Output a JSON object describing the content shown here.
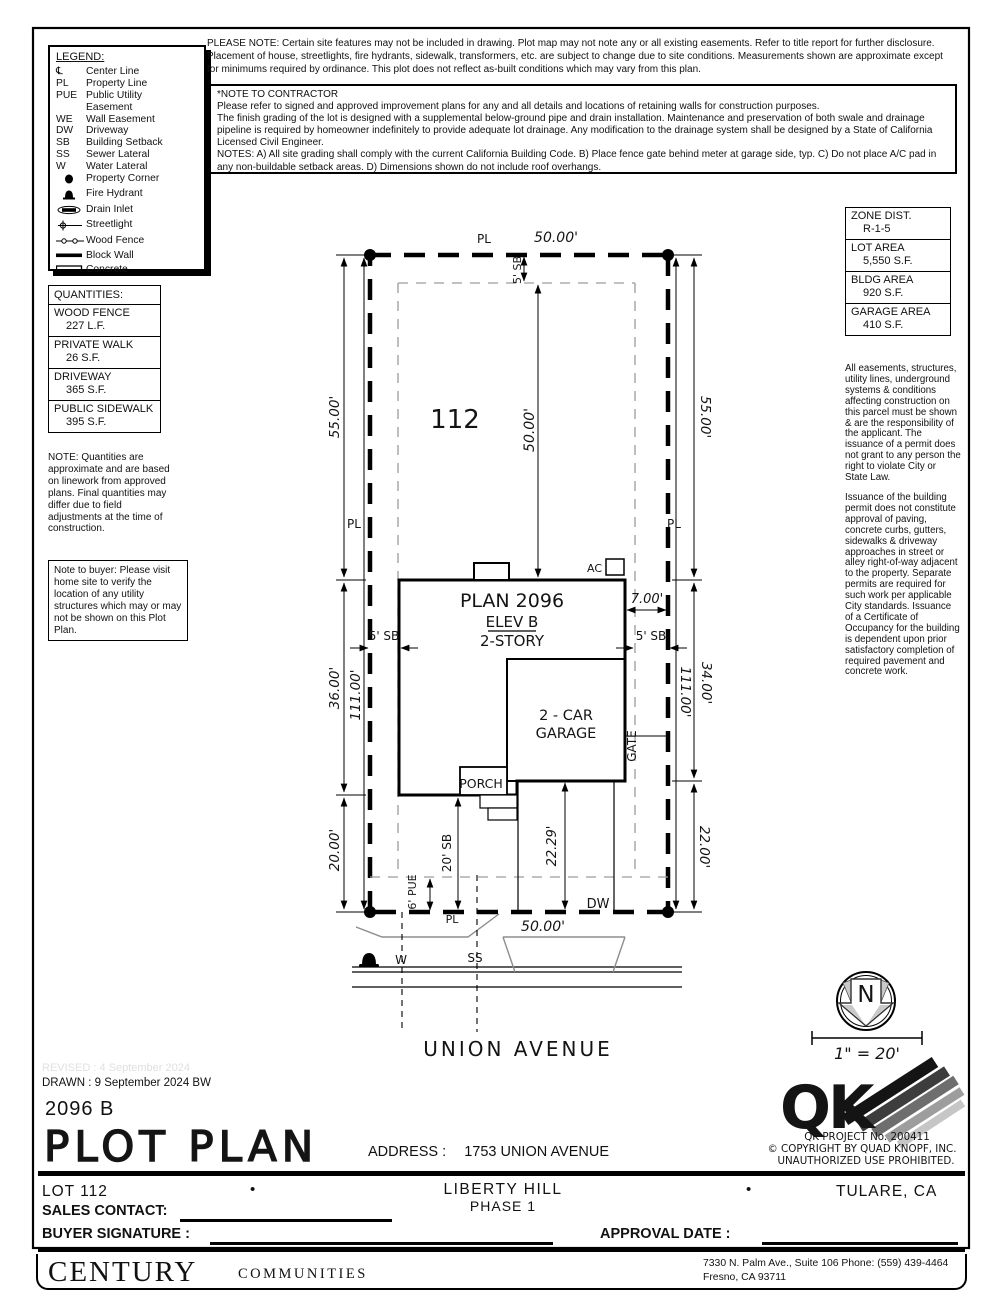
{
  "header": {
    "please_note": "PLEASE NOTE:  Certain site features may not be included in drawing.  Plot map may not note any or all existing easements. Refer to title report for further disclosure.  Placement of house, streetlights, fire hydrants, sidewalk, transformers, etc. are subject to change due to site conditions.  Measurements shown are approximate except for minimums required by ordinance.  This plot does not reflect as-built conditions which may vary from this plan.",
    "contractor_title": "*NOTE TO CONTRACTOR",
    "contractor_p1": "Please refer to signed and approved improvement plans for any and all details and locations of retaining walls for construction purposes.",
    "contractor_p2": "The finish grading of the lot is designed with a supplemental below-ground pipe and drain installation.  Maintenance and preservation of both swale and drainage pipeline is required by homeowner indefinitely to provide adequate lot drainage.  Any modification to the drainage system shall be designed by a State of California Licensed Civil Engineer.",
    "contractor_p3": "NOTES:  A) All site grading shall comply with the current California Building Code.  B) Place fence gate behind meter at garage side, typ.  C) Do not place A/C pad in any non-buildable setback areas.  D) Dimensions shown do not include roof overhangs."
  },
  "legend": {
    "title": "LEGEND:",
    "items": [
      {
        "sym": "℄",
        "label": "Center Line"
      },
      {
        "sym": "PL",
        "label": "Property Line"
      },
      {
        "sym": "PUE",
        "label": "Public Utility Easement"
      },
      {
        "sym": "WE",
        "label": "Wall Easement"
      },
      {
        "sym": "DW",
        "label": "Driveway"
      },
      {
        "sym": "SB",
        "label": "Building Setback"
      },
      {
        "sym": "SS",
        "label": "Sewer Lateral"
      },
      {
        "sym": "W",
        "label": "Water Lateral"
      },
      {
        "sym": "",
        "label": "Property Corner"
      },
      {
        "sym": "",
        "label": "Fire Hydrant"
      },
      {
        "sym": "",
        "label": "Drain Inlet"
      },
      {
        "sym": "",
        "label": "Streetlight"
      },
      {
        "sym": "",
        "label": "Wood Fence"
      },
      {
        "sym": "",
        "label": "Block Wall"
      },
      {
        "sym": "",
        "label": "Concrete"
      }
    ]
  },
  "zone_table": {
    "rows": [
      {
        "label": "ZONE DIST.",
        "value": "R-1-5"
      },
      {
        "label": "LOT AREA",
        "value": "5,550 S.F."
      },
      {
        "label": "BLDG AREA",
        "value": "920 S.F."
      },
      {
        "label": "GARAGE AREA",
        "value": "410 S.F."
      }
    ]
  },
  "quantities": {
    "title": "QUANTITIES:",
    "rows": [
      {
        "label": "WOOD FENCE",
        "value": "227 L.F."
      },
      {
        "label": "PRIVATE WALK",
        "value": "26 S.F."
      },
      {
        "label": "DRIVEWAY",
        "value": "365 S.F."
      },
      {
        "label": "PUBLIC SIDEWALK",
        "value": "395 S.F."
      }
    ],
    "note": "NOTE: Quantities are approximate and are based on linework from approved plans.  Final quantities may differ due to field adjustments at the time of construction."
  },
  "buyer_note": "Note to buyer: Please visit home site to verify the location of any utility structures which may or may not be shown on this Plot Plan.",
  "side_notes": {
    "p1": "All easements, structures, utility lines, underground systems & conditions affecting construction on this parcel must be shown & are the responsibility of the applicant. The issuance of a permit does not grant to any person the right to violate City or State Law.",
    "p2": "Issuance of the building permit does not constitute approval of paving, concrete curbs, gutters, sidewalks & driveway approaches in street or alley right-of-way adjacent to the property. Separate permits are required for such work per applicable City standards. Issuance of a Certificate of Occupancy for the building is dependent upon prior satisfactory completion of required pavement and concrete work."
  },
  "plot": {
    "lot_number": "112",
    "pl_label": "PL",
    "dims": {
      "top_width": "50.00'",
      "bottom_width": "50.00'",
      "front_depth": "50.00'",
      "sb_front": "5' SB",
      "sb_side_left": "5' SB",
      "sb_side_right": "5' SB",
      "sb_rear": "20' SB",
      "pue_rear": "6' PUE",
      "left_55": "55.00'",
      "left_36": "36.00'",
      "left_20": "20.00'",
      "left_total": "111.00'",
      "right_55": "55.00'",
      "right_34": "34.00'",
      "right_22": "22.00'",
      "right_total": "111.00'",
      "garage_side": "7.00'",
      "drive_len": "22.29'"
    },
    "house": {
      "plan": "PLAN 2096",
      "elev": "ELEV B",
      "stories": "2-STORY",
      "garage1": "2 - CAR",
      "garage2": "GARAGE",
      "porch": "PORCH",
      "ac": "AC",
      "gate": "GATE",
      "dw": "DW"
    },
    "street": {
      "name": "UNION AVENUE",
      "w": "W",
      "ss": "SS"
    }
  },
  "north_scale": {
    "n": "N",
    "scale": "1\" = 20'"
  },
  "qk": {
    "logo": "QK",
    "line1": "QK PROJECT No. 200411",
    "line2": "©  COPYRIGHT BY QUAD KNOPF, INC.",
    "line3": "UNAUTHORIZED USE PROHIBITED."
  },
  "title_block": {
    "revised": "REVISED :  4 September 2024",
    "drawn": "DRAWN :  9 September 2024  BW",
    "plan_code": "2096 B",
    "sheet_title": "PLOT PLAN",
    "address_label": "ADDRESS :",
    "address_value": "1753 UNION AVENUE"
  },
  "footer": {
    "lot": "LOT 112",
    "bullet": "•",
    "community": "LIBERTY HILL",
    "phase": "PHASE 1",
    "city": "TULARE, CA",
    "sales_label": "SALES CONTACT:",
    "signature_label": "BUYER SIGNATURE :",
    "approval_label": "APPROVAL DATE :",
    "brand_main": "CENTURY",
    "brand_sub": "COMMUNITIES",
    "addr_line1": "7330 N. Palm Ave., Suite 106    Phone:  (559) 439-4464",
    "addr_line2": "Fresno, CA  93711"
  }
}
